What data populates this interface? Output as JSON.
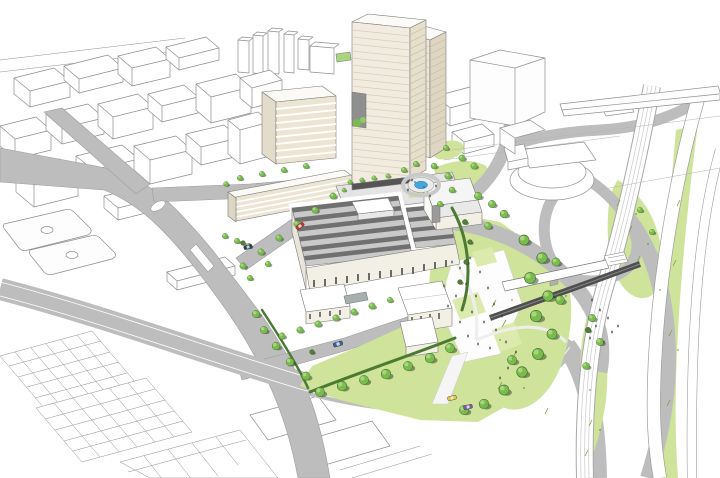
{
  "meta": {
    "type": "architectural-aerial-rendering",
    "view": "birds-eye perspective",
    "content": "Aerial masterplan illustration: white massing-model city blocks, a beige twin-slab landmark tower with sky-garden notch, a sawtooth-roof industrial complex, a circular fountain plaza, a tree-filled park with white plaza and pedestrian footbridge over rail, and a motorway interchange with grass infields"
  },
  "palette": {
    "background": "#ffffff",
    "outline": "#8e8e8e",
    "road": "#bdbdbd",
    "road_light": "#d9d9d9",
    "grass": "#cfe39b",
    "lawn": "#dcebad",
    "tree": "#79bb4d",
    "tree_light": "#a9d57f",
    "tree_shadow": "#2a3b20",
    "bush": "#527d36",
    "hedge": "#4c7a33",
    "tower_facade": "#f1ecdf",
    "tower_side": "#e6dfcc",
    "tower_lines": "#d6cfbc",
    "building_cream": "#f2efe4",
    "building_stripe": "#ece5d4",
    "factory_roof": "#c9c9c9",
    "roof_slat": "#707070",
    "water": "#45a7d9",
    "rail_dark": "#4f4f4f",
    "people": "#3c3c3c"
  },
  "landmarks": {
    "tower": "twin-slab high-rise with sky-garden notch",
    "factory": "sawtooth-roof industrial complex",
    "arena": "oval event hall",
    "footbridge": "pedestrian bridge over railway",
    "fountain": "circular plaza fountain",
    "interchange": "motorway interchange with grass infields",
    "city": "white wireframe city blocks",
    "park": "tree-filled park with white plaza"
  },
  "cars": [
    {
      "label": "red-car",
      "color": "#c0392b"
    },
    {
      "label": "navy-car",
      "color": "#2c3e66"
    },
    {
      "label": "dark-blue-car",
      "color": "#3a5fa8"
    },
    {
      "label": "yellow-car",
      "color": "#e3c23c"
    },
    {
      "label": "purple-car",
      "color": "#7e57a8"
    }
  ],
  "counts": {
    "cars": 5,
    "sports_courts": 2,
    "trees_approx": 80
  }
}
